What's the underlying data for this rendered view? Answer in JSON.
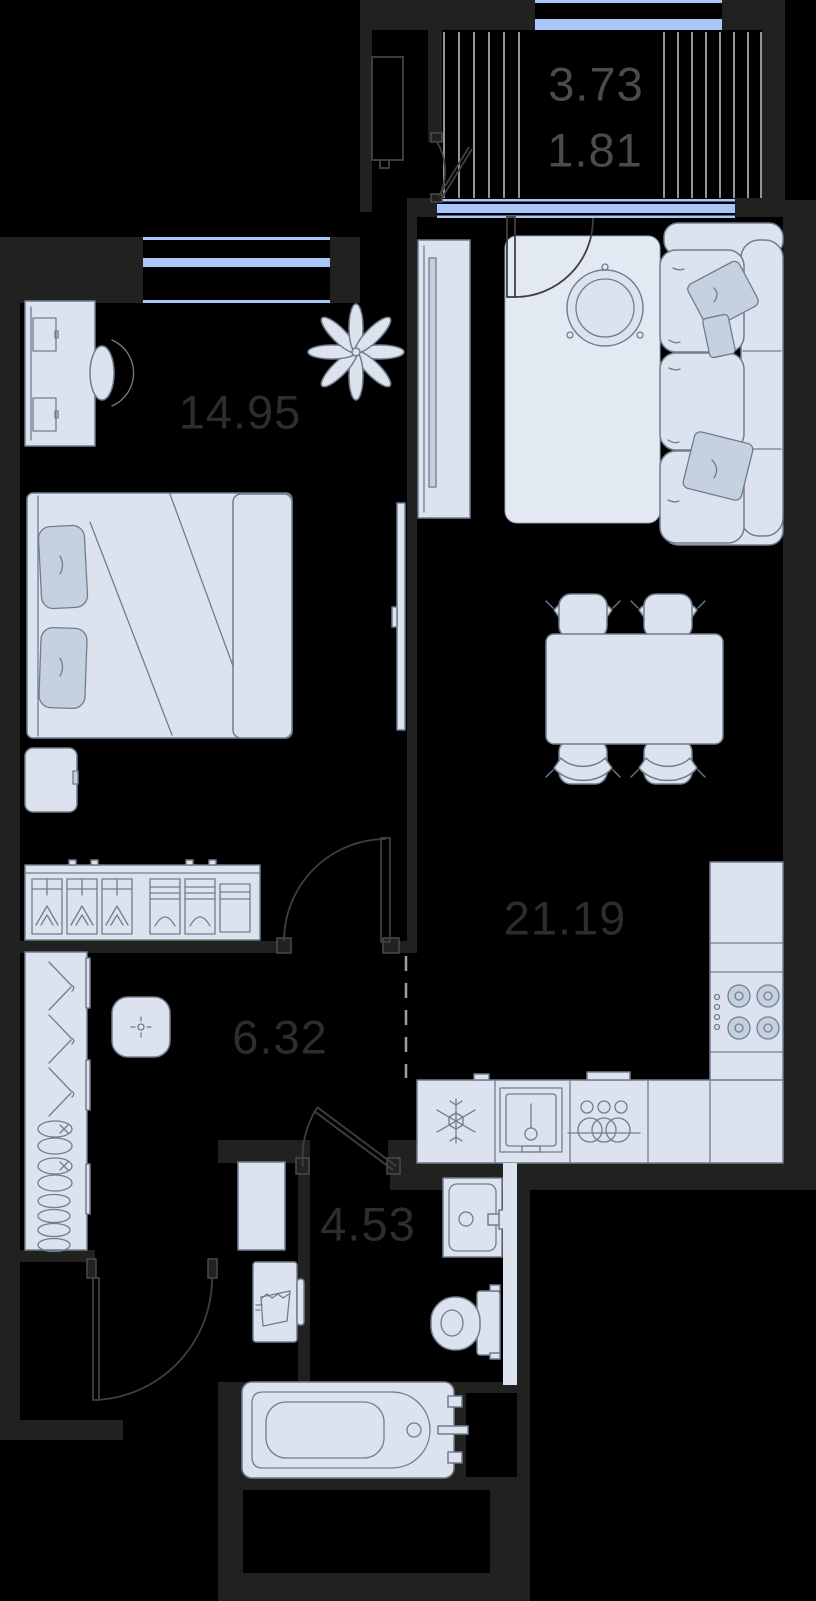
{
  "rooms": {
    "balcony": {
      "area_total": "3.73",
      "area_reduced": "1.81"
    },
    "bedroom": {
      "area": "14.95"
    },
    "living_kitchen": {
      "area": "21.19"
    },
    "hallway": {
      "area": "6.32"
    },
    "bathroom": {
      "area": "4.53"
    }
  },
  "colors": {
    "wall": "#212120",
    "floor": "#000000",
    "window_glass": "#a8c7f8",
    "furniture_fill": "#dce3ee",
    "furniture_stroke": "#6f7e8e",
    "furniture_accent": "#c5d1e1",
    "rug": "#e3e9f2",
    "hatch_line": "#8e959c",
    "door_line": "#3f3f3f",
    "room_label": "#2d2d31",
    "balcony_label": "#4b4b4f",
    "dashed_line": "#9aa0a6"
  },
  "icons": [
    "snowflake-icon",
    "faucet-icon",
    "dish-rings-icon",
    "hanger-icon",
    "shoes-icon",
    "plus-marker-icon",
    "wave-basin-icon",
    "burner-icon",
    "plant-icon"
  ]
}
